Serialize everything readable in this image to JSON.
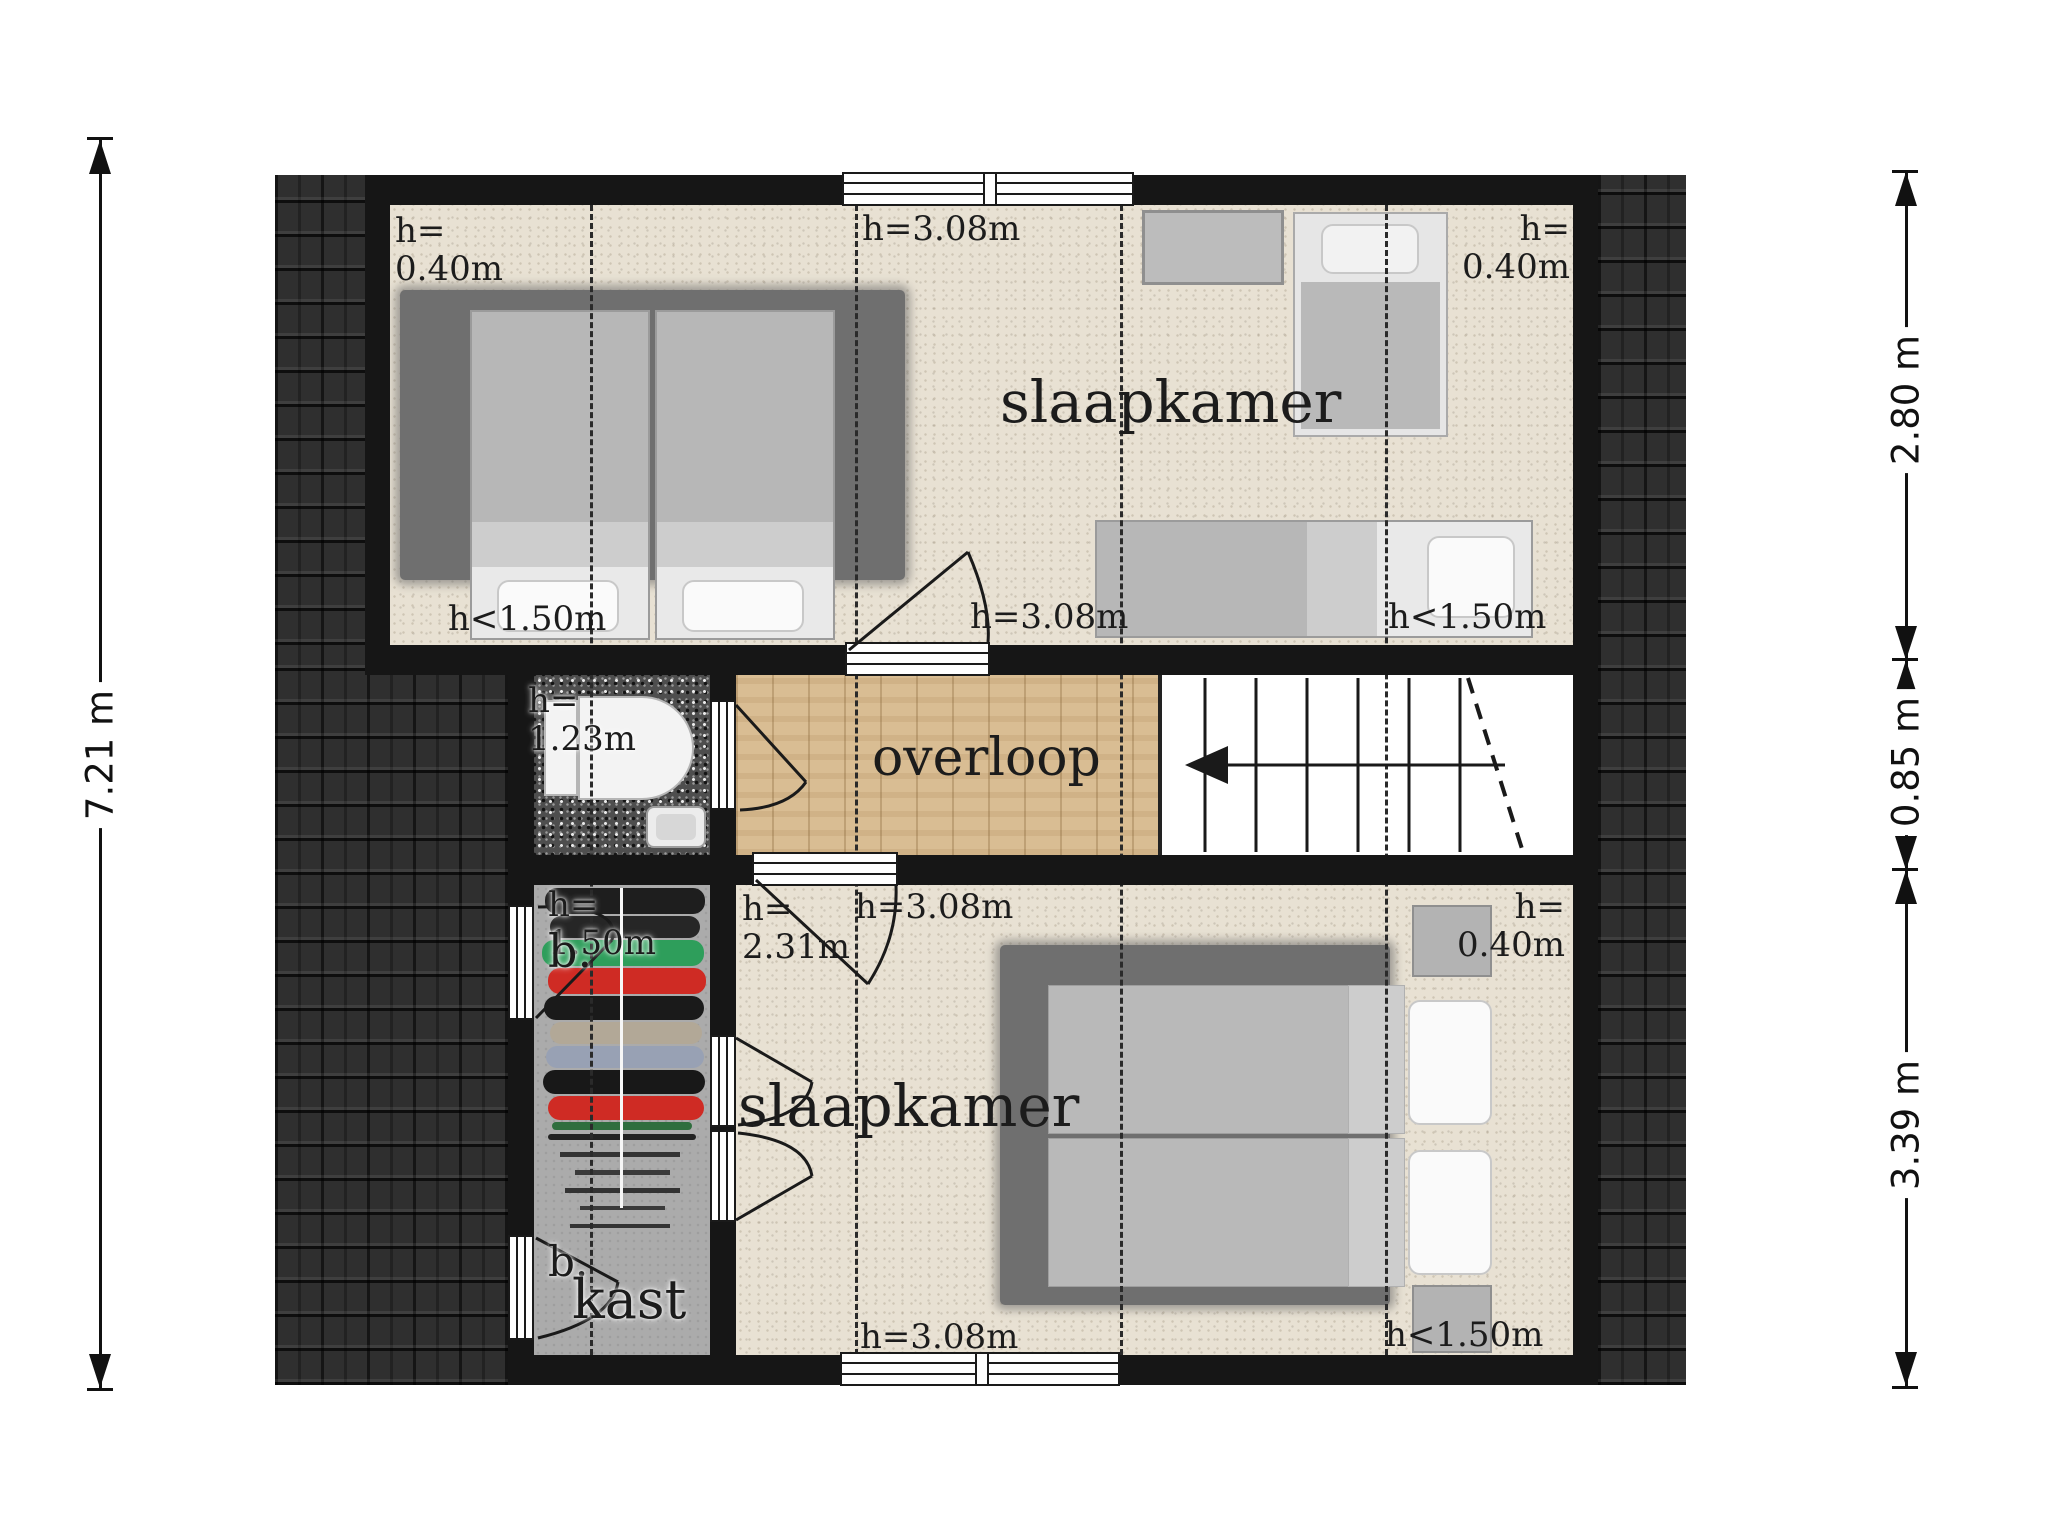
{
  "plan_type": "floor-plan",
  "floor_labels": {
    "bedroom_top": "slaapkamer",
    "landing": "overloop",
    "closet": "kast",
    "bedroom_bottom": "slaapkamer"
  },
  "height_labels": {
    "top_left": "h=\n0.40m",
    "top_center": "h=3.08m",
    "top_right": "h=\n0.40m",
    "mid_left": "h<1.50m",
    "mid_door": "h=3.08m",
    "mid_right": "h<1.50m",
    "toilet": "h=\n1.23m",
    "closet": "h=\n1.50m",
    "closet_door_top": "b.",
    "closet_door_bottom": "b.",
    "bottom_left": "h=\n2.31m",
    "bottom_door": "h=3.08m",
    "bottom_right_top": "h=\n0.40m",
    "bottom_center": "h=3.08m",
    "bottom_right": "h<1.50m"
  },
  "dimensions": {
    "overall_height": "7.21 m",
    "right_top": "2.80 m",
    "right_middle": "0.85 m",
    "right_bottom": "3.39 m"
  },
  "colors": {
    "wall": "#161616",
    "roof_tiles": "#2f2f2f",
    "carpet": "#e8e1d3",
    "wood_floor": "#d9bd93",
    "closet_floor": "#ababab",
    "toilet_floor": "#4e4e4e",
    "rug": "#6f6f6f",
    "clothes_red": "#cf2b24",
    "clothes_green": "#2e9e5b",
    "clothes_blue_gray": "#98a1b4",
    "clothes_tan": "#b2a897"
  }
}
